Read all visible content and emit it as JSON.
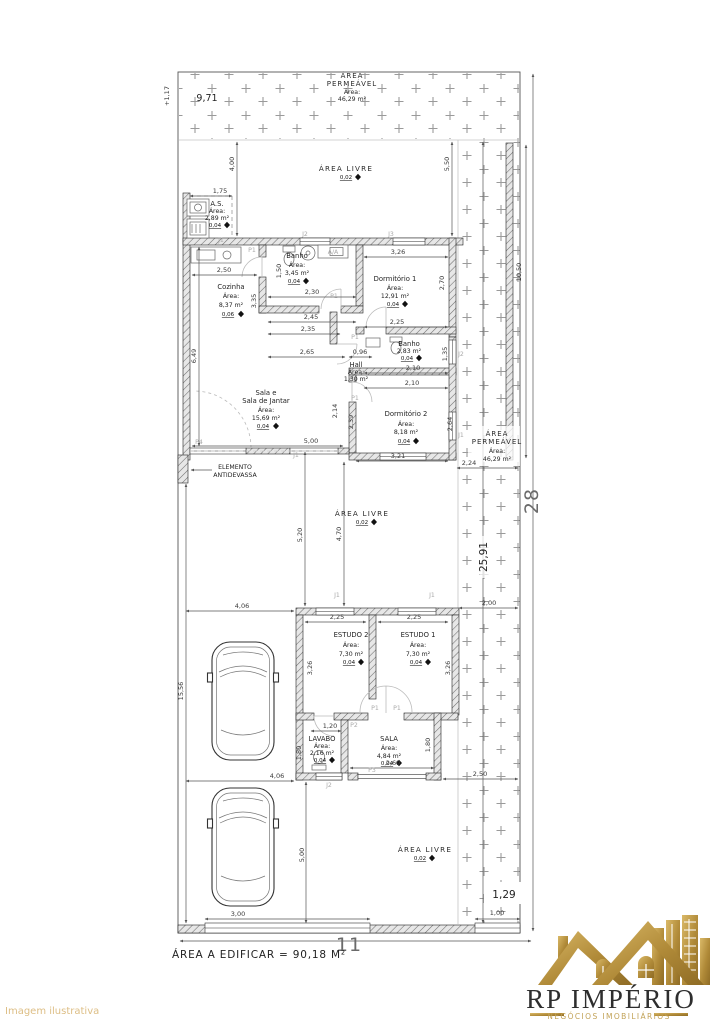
{
  "watermark": "Imagem ilustrativa",
  "labels": {
    "area_word": "Área:"
  },
  "permeavel": {
    "l1": "ÁREA",
    "l2": "PERMEÁVEL",
    "area": "46,29 m²"
  },
  "area_livre": {
    "label": "ÁREA LIVRE",
    "level": "0,02"
  },
  "elemento": {
    "l1": "ELEMENTO",
    "l2": "ANTIDEVASSA"
  },
  "rooms": {
    "as": {
      "name": "A.S.",
      "area": "2,89 m²",
      "level": "0,04"
    },
    "cozinha": {
      "name": "Cozinha",
      "area": "8,37 m²",
      "level": "0,06"
    },
    "banho1": {
      "name": "Banho",
      "area": "3,45 m²",
      "level": "0,04"
    },
    "dorm1": {
      "name": "Dormitório 1",
      "area": "12,91 m²",
      "level": "0,04"
    },
    "hall": {
      "name": "Hall",
      "area": "1,30 m²"
    },
    "banho2": {
      "name": "Banho",
      "area": "2,83 m²",
      "level": "0,04"
    },
    "dorm2": {
      "name": "Dormitório 2",
      "area": "8,18 m²",
      "level": "0,04"
    },
    "sala_jantar": {
      "name1": "Sala e",
      "name2": "Sala de Jantar",
      "area": "15,69 m²",
      "level": "0,04"
    },
    "estudo2": {
      "name": "ESTUDO 2",
      "area": "7,30 m²",
      "level": "0,04"
    },
    "estudo1": {
      "name": "ESTUDO 1",
      "area": "7,30 m²",
      "level": "0,04"
    },
    "lavabo": {
      "name": "LAVABO",
      "area": "2,16 m²",
      "level": "0,04"
    },
    "sala": {
      "name": "SALA",
      "area": "4,84 m²",
      "level": "0,04"
    }
  },
  "dims": {
    "d117": "+1,17",
    "d971": "9,71",
    "d400": "4,00",
    "d550": "5,50",
    "d1050": "10,50",
    "d175": "1,75",
    "d250": "2,50",
    "d150": "1,50",
    "d230": "2,30",
    "d245": "2,45",
    "d326": "3,26",
    "d335": "3,35",
    "d270": "2,70",
    "d225": "2,25",
    "d235": "2,35",
    "d265": "2,65",
    "d096": "0,96",
    "d649": "6,49",
    "d214": "2,14",
    "d239": "2,39",
    "d210": "2,10",
    "d135": "1,35",
    "d264": "2,64",
    "d321": "3,21",
    "d500": "5,00",
    "d224": "2,24",
    "d2591": "25,91",
    "d520": "5,20",
    "d470": "4,70",
    "d200": "2,00",
    "d1556": "15,56",
    "d406": "4,06",
    "d120": "1,20",
    "d180": "1,80",
    "d269": "2,69",
    "d300": "3,00",
    "d100": "1,00",
    "d129": "1,29",
    "d11": "11",
    "d28": "28"
  },
  "openings": {
    "j1": "J1",
    "j2": "J2",
    "j3": "J3",
    "p1": "P1",
    "p2": "P2",
    "p3": "P3",
    "p4": "P4",
    "aa": "A/A"
  },
  "footer": {
    "area_edificar": "ÁREA A EDIFICAR = 90,18 M²"
  },
  "logo": {
    "name": "RP IMPÉRIO",
    "tagline": "NEGÓCIOS IMOBILIÁRIOS"
  }
}
